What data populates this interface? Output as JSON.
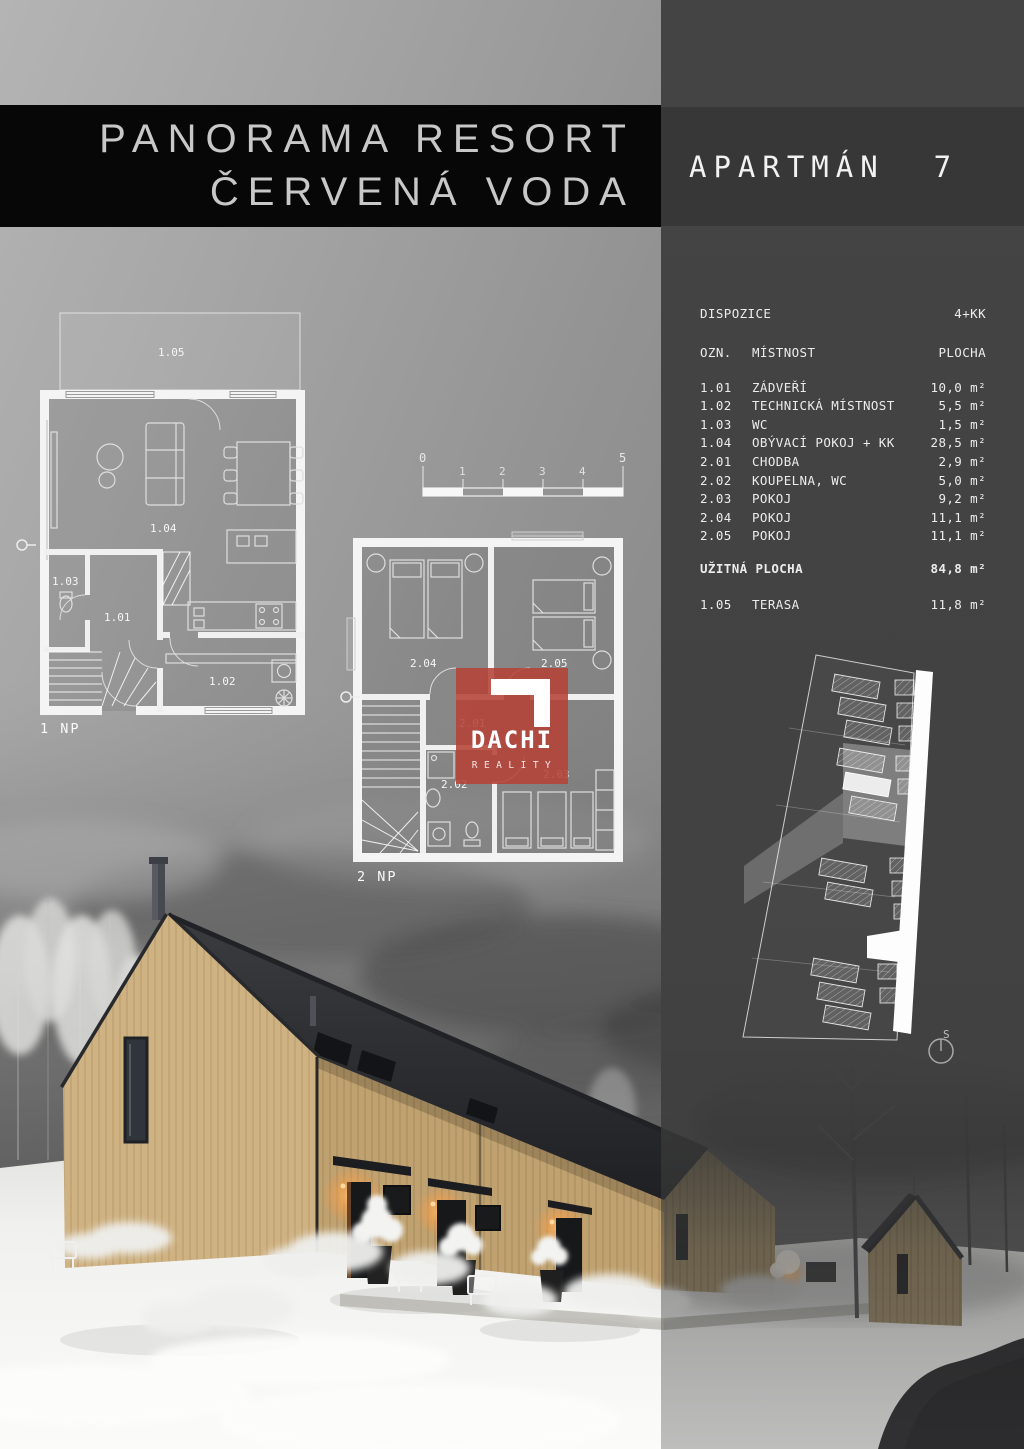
{
  "page": {
    "title_line1": "PANORAMA RESORT",
    "title_line2": "ČERVENÁ VODA",
    "apartment": "APARTMÁN  7"
  },
  "table": {
    "dispozice_label": "DISPOZICE",
    "dispozice_value": "4+KK",
    "headers": {
      "ozn": "OZN.",
      "mistnost": "MÍSTNOST",
      "plocha": "PLOCHA"
    },
    "rows": [
      {
        "ozn": "1.01",
        "mistnost": "ZÁDVEŘÍ",
        "plocha": "10,0 m²"
      },
      {
        "ozn": "1.02",
        "mistnost": "TECHNICKÁ MÍSTNOST",
        "plocha": "5,5 m²"
      },
      {
        "ozn": "1.03",
        "mistnost": "WC",
        "plocha": "1,5 m²"
      },
      {
        "ozn": "1.04",
        "mistnost": "OBÝVACÍ POKOJ + KK",
        "plocha": "28,5 m²"
      },
      {
        "ozn": "2.01",
        "mistnost": "CHODBA",
        "plocha": "2,9 m²"
      },
      {
        "ozn": "2.02",
        "mistnost": "KOUPELNA, WC",
        "plocha": "5,0 m²"
      },
      {
        "ozn": "2.03",
        "mistnost": "POKOJ",
        "plocha": "9,2 m²"
      },
      {
        "ozn": "2.04",
        "mistnost": "POKOJ",
        "plocha": "11,1 m²"
      },
      {
        "ozn": "2.05",
        "mistnost": "POKOJ",
        "plocha": "11,1 m²"
      }
    ],
    "total": {
      "label": "UŽITNÁ PLOCHA",
      "value": "84,8 m²"
    },
    "terasa_row": {
      "ozn": "1.05",
      "mistnost": "TERASA",
      "plocha": "11,8 m²"
    }
  },
  "floor1": {
    "caption": "1 NP",
    "room_terasa": "1.05",
    "room_obyvaci": "1.04",
    "room_wc": "1.03",
    "room_zadveri": "1.01",
    "room_technicka": "1.02"
  },
  "floor2": {
    "caption": "2 NP",
    "room_pokoj_a": "2.04",
    "room_pokoj_b": "2.05",
    "room_chodba": "2.01",
    "room_koupelna": "2.02",
    "room_pokoj_c": "2.03"
  },
  "scalebar": {
    "ticks": [
      "0",
      "1",
      "2",
      "3",
      "4",
      "5"
    ]
  },
  "siteplan": {
    "compass": "S"
  },
  "logo": {
    "name": "DACHI",
    "subtitle": "REALITY"
  },
  "colors": {
    "accent_red": "#b6453c",
    "panel": "#424242",
    "band_black": "#070707",
    "wood": "#c0a270",
    "roof": "#2a2b2e"
  }
}
